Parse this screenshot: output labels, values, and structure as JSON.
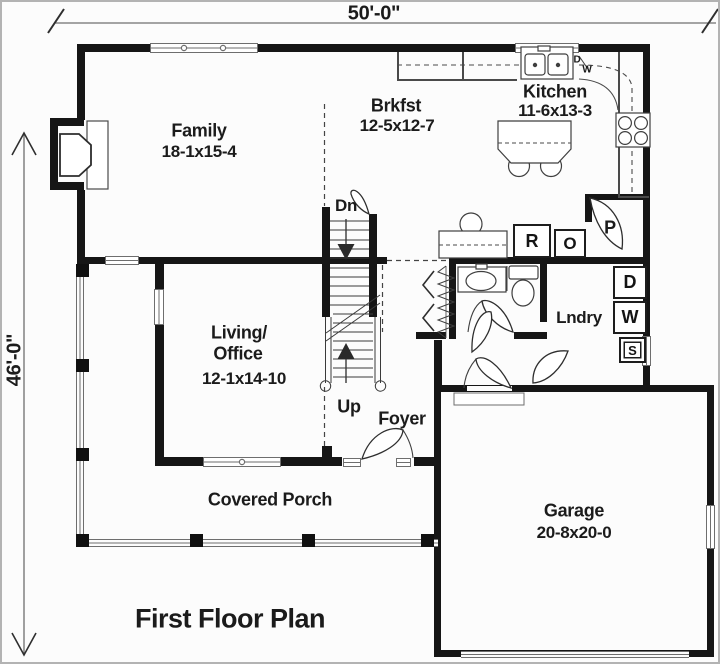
{
  "title": "First Floor Plan",
  "dimensions": {
    "top": "50'-0\"",
    "left": "46'-0\""
  },
  "rooms": {
    "family": {
      "name": "Family",
      "size": "18-1x15-4"
    },
    "brkfst": {
      "name": "Brkfst",
      "size": "12-5x12-7"
    },
    "kitchen": {
      "name": "Kitchen",
      "size": "11-6x13-3"
    },
    "living": {
      "line1": "Living/",
      "line2": "Office",
      "size": "12-1x14-10"
    },
    "foyer": {
      "name": "Foyer"
    },
    "laundry": {
      "name": "Lndry"
    },
    "garage": {
      "name": "Garage",
      "size": "20-8x20-0"
    },
    "porch": {
      "name": "Covered Porch"
    }
  },
  "stairs": {
    "down_label": "Dn",
    "up_label": "Up"
  },
  "appliances": {
    "refrigerator": "R",
    "oven": "O",
    "pantry": "P",
    "dryer": "D",
    "washer": "W",
    "sink": "S",
    "dishwasher_d": "D",
    "dishwasher_w": "W"
  },
  "colors": {
    "wall": "#161616",
    "line": "#4a4a4a",
    "background": "#fcfcfc"
  }
}
